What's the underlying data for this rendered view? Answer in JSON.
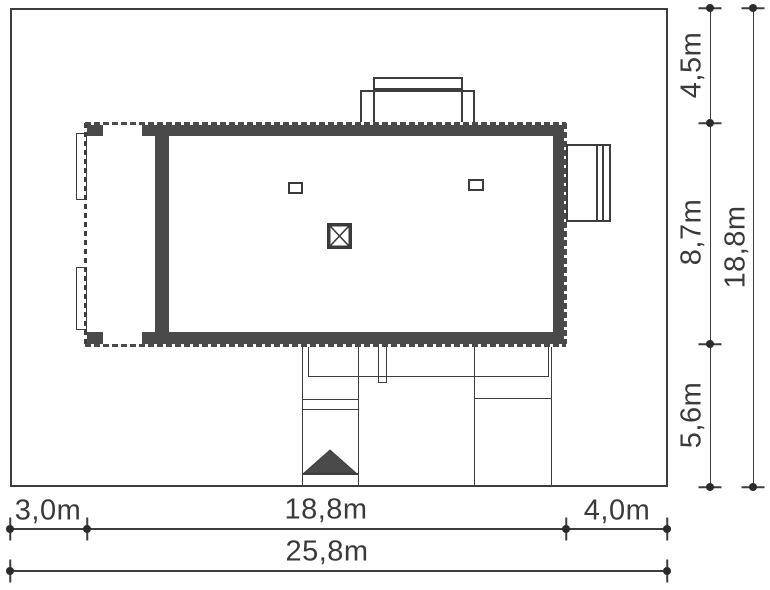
{
  "diagram": {
    "kind": "architectural-site-plan",
    "features": {
      "house": "house-footprint",
      "covered_terrace": "covered-terrace-dashed-outline",
      "chimney": "chimney-with-x-symbol",
      "roof_windows": [
        "roof-window-left",
        "roof-window-right"
      ],
      "top_dormer": "top-dormer-outline",
      "side_bay": "right-side-bay-outline",
      "entrance": "entrance-arrow"
    }
  },
  "dims": {
    "bottom": {
      "segments": [
        "3,0m",
        "18,8m",
        "4,0m"
      ],
      "total": "25,8m"
    },
    "right": {
      "segments": [
        "4,5m",
        "8,7m",
        "5,6m"
      ],
      "total": "18,8m"
    }
  },
  "colors": {
    "background": "#ffffff",
    "wall": "#4a4a4a",
    "line": "#3d3d3d",
    "text": "#3a3a3a"
  }
}
